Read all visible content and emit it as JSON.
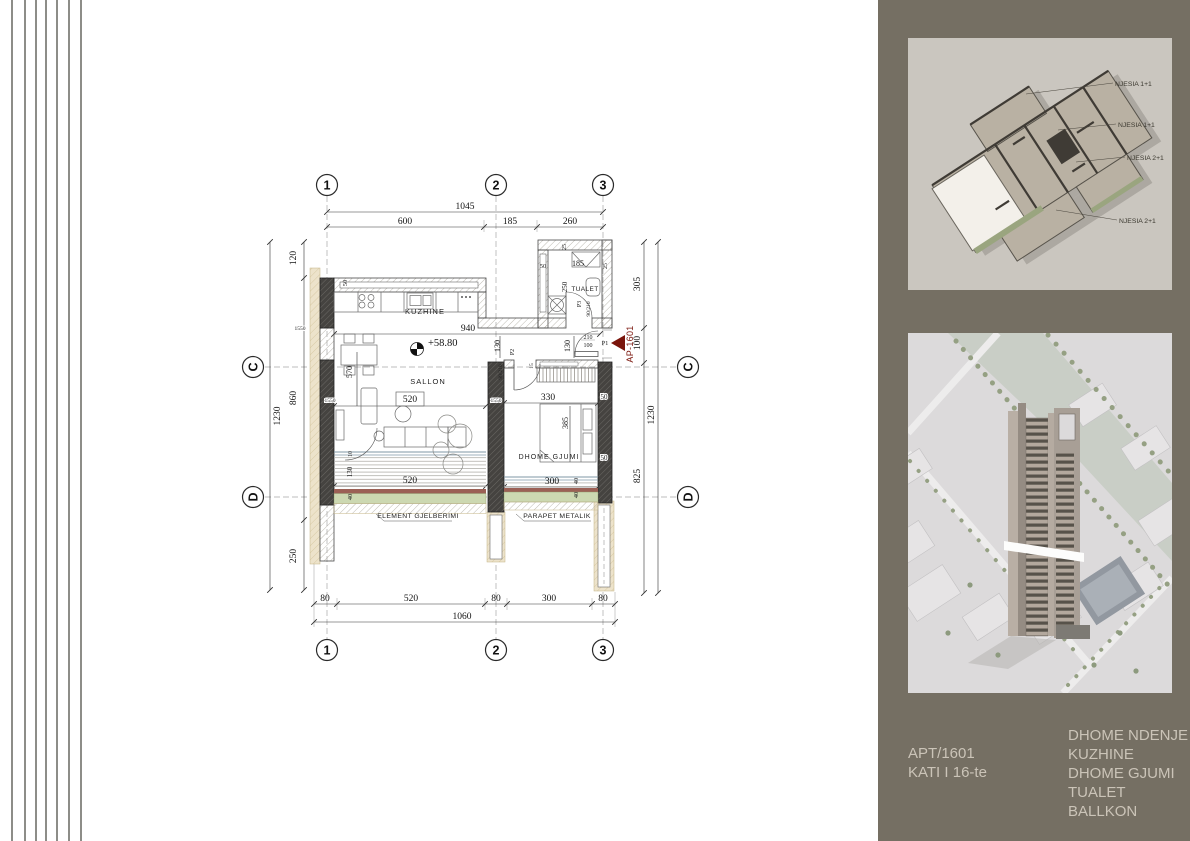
{
  "colors": {
    "panel_bg": "#756f63",
    "footer_text": "#cbc4b8",
    "accent_red": "#7a140b",
    "greenery_green": "#ccd8b1",
    "parapet_red": "#9b6055",
    "column_dark": "#454340",
    "tan_exterior": "#ede3cb"
  },
  "plan": {
    "grid": {
      "g1": "1",
      "g2": "2",
      "g3": "3",
      "gc": "C",
      "gd": "D"
    },
    "rooms": {
      "kitchen": "KUZHINE",
      "living": "SALLON",
      "bedroom": "DHOME GJUMI",
      "toilet": "TUALET"
    },
    "level": "+58.80",
    "marker": {
      "label": "AP-1601"
    },
    "doors": {
      "p1": "P1",
      "p2": "P2",
      "p3": "P3",
      "spec_90_210": "90/210",
      "spec_210": "210",
      "spec_100": "100"
    },
    "callouts": {
      "greenery": "ELEMENT GJELBERIMI",
      "parapet": "PARAPET METALIK"
    },
    "dims": {
      "d1045": "1045",
      "d600": "600",
      "d185": "185",
      "d260": "260",
      "d80": "80",
      "d520": "520",
      "d300": "300",
      "d1060": "1060",
      "d120": "120",
      "d860": "860",
      "d1230": "1230",
      "d250": "250",
      "d305": "305",
      "d100": "100",
      "d825": "825",
      "d940": "940",
      "d130": "130",
      "d570": "570",
      "d1550": "1550",
      "d330": "330",
      "d385": "385",
      "d50": "50",
      "d25": "25",
      "d40": "40",
      "d10": "10",
      "d15": "15"
    }
  },
  "panel": {
    "axon_labels": [
      "NJESIA 1+1",
      "NJESIA 1+1",
      "NJESIA 2+1",
      "NJESIA 2+1"
    ],
    "footer": {
      "apt": "APT/1601",
      "floor": "KATI I 16-te",
      "room_list": [
        "DHOME NDENJE",
        "KUZHINE",
        "DHOME GJUMI",
        "TUALET",
        "BALLKON"
      ]
    }
  }
}
